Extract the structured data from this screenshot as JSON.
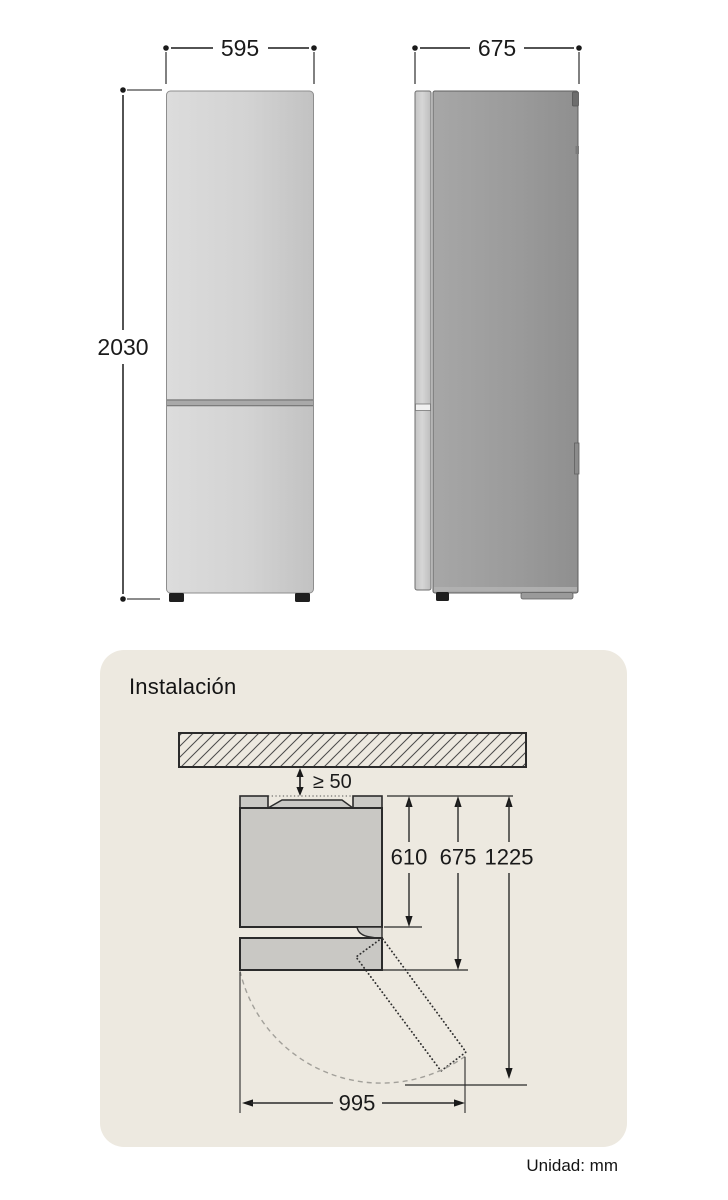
{
  "figure": {
    "front": {
      "width_label": "595",
      "height_label": "2030"
    },
    "side": {
      "depth_label": "675"
    }
  },
  "installation": {
    "title": "Instalación",
    "clearance_label": "≥ 50",
    "cabinet_depth_label": "610",
    "total_depth_label": "675",
    "open_depth_label": "1225",
    "open_width_label": "995"
  },
  "footer": {
    "unit_label": "Unidad: mm"
  },
  "colors": {
    "card_bg": "#EDE9E0",
    "dimension_line": "#1a1a1a",
    "front_fridge": "#d2d2d2",
    "side_fridge": "#9c9c9c",
    "diagram_fill": "#c9c8c4",
    "diagram_stroke": "#2b2b2b"
  }
}
